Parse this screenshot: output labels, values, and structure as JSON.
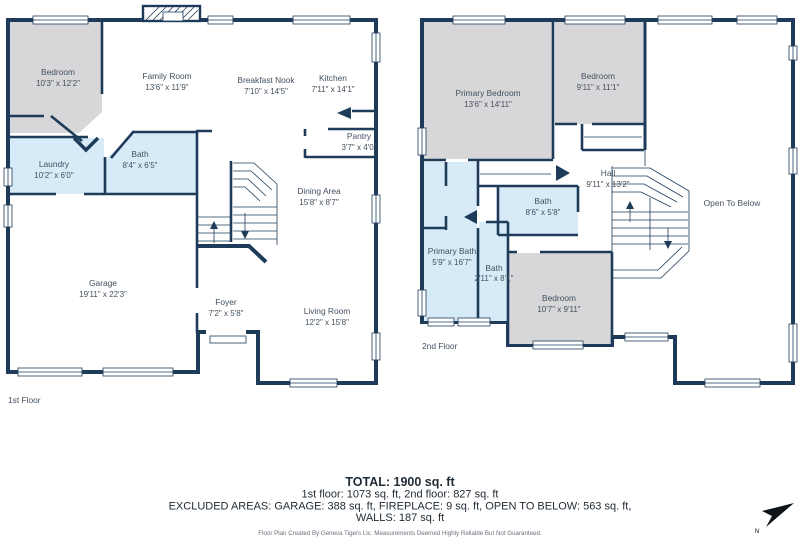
{
  "colors": {
    "wall": "#1e3c5a",
    "floor": "#eaeaec",
    "bedroom_fill": "#d7d7d9",
    "bath_fill": "#d6eaf8",
    "label_text": "#42505f",
    "footer_text": "#1f2a35",
    "fine_print": "#6a737d",
    "north_arrow": "#0f1419"
  },
  "floor1": {
    "label": "1st Floor",
    "rooms": [
      {
        "name": "Bedroom",
        "dims": "10'3\" x 12'2\""
      },
      {
        "name": "Family Room",
        "dims": "13'6\" x 11'9\""
      },
      {
        "name": "Breakfast Nook",
        "dims": "7'10\" x 14'5\""
      },
      {
        "name": "Kitchen",
        "dims": "7'11\" x 14'1\""
      },
      {
        "name": "Pantry",
        "dims": "3'7\" x 4'0\""
      },
      {
        "name": "Laundry",
        "dims": "10'2\" x 6'0\""
      },
      {
        "name": "Bath",
        "dims": "8'4\" x 6'5\""
      },
      {
        "name": "Dining Area",
        "dims": "15'8\" x 8'7\""
      },
      {
        "name": "Garage",
        "dims": "19'11\" x 22'3\""
      },
      {
        "name": "Foyer",
        "dims": "7'2\" x 5'8\""
      },
      {
        "name": "Living Room",
        "dims": "12'2\" x 15'8\""
      }
    ]
  },
  "floor2": {
    "label": "2nd Floor",
    "rooms": [
      {
        "name": "Primary Bedroom",
        "dims": "13'6\" x 14'11\""
      },
      {
        "name": "Bedroom",
        "dims": "9'11\" x 11'1\""
      },
      {
        "name": "Open To Below",
        "dims": ""
      },
      {
        "name": "Hall",
        "dims": "9'11\" x 13'2\""
      },
      {
        "name": "Bath",
        "dims": "8'6\" x 5'8\""
      },
      {
        "name": "Primary Bath",
        "dims": "5'9\" x 16'7\""
      },
      {
        "name": "Bath",
        "dims": "2'11\" x 8'1\""
      },
      {
        "name": "Bedroom",
        "dims": "10'7\" x 9'11\""
      }
    ]
  },
  "summary": {
    "total": "TOTAL: 1900 sq. ft",
    "floors": "1st floor: 1073 sq. ft, 2nd floor: 827 sq. ft",
    "excluded": "EXCLUDED AREAS: GARAGE: 388 sq. ft, FIREPLACE: 9 sq. ft, OPEN TO BELOW: 563 sq. ft,",
    "walls": "WALLS: 187 sq. ft",
    "credit": "Floor Plan Created By Geneva Tigers Llc. Measurements Deemed Highly Reliable But Not Guaranteed."
  },
  "compass": {
    "label": "N"
  }
}
